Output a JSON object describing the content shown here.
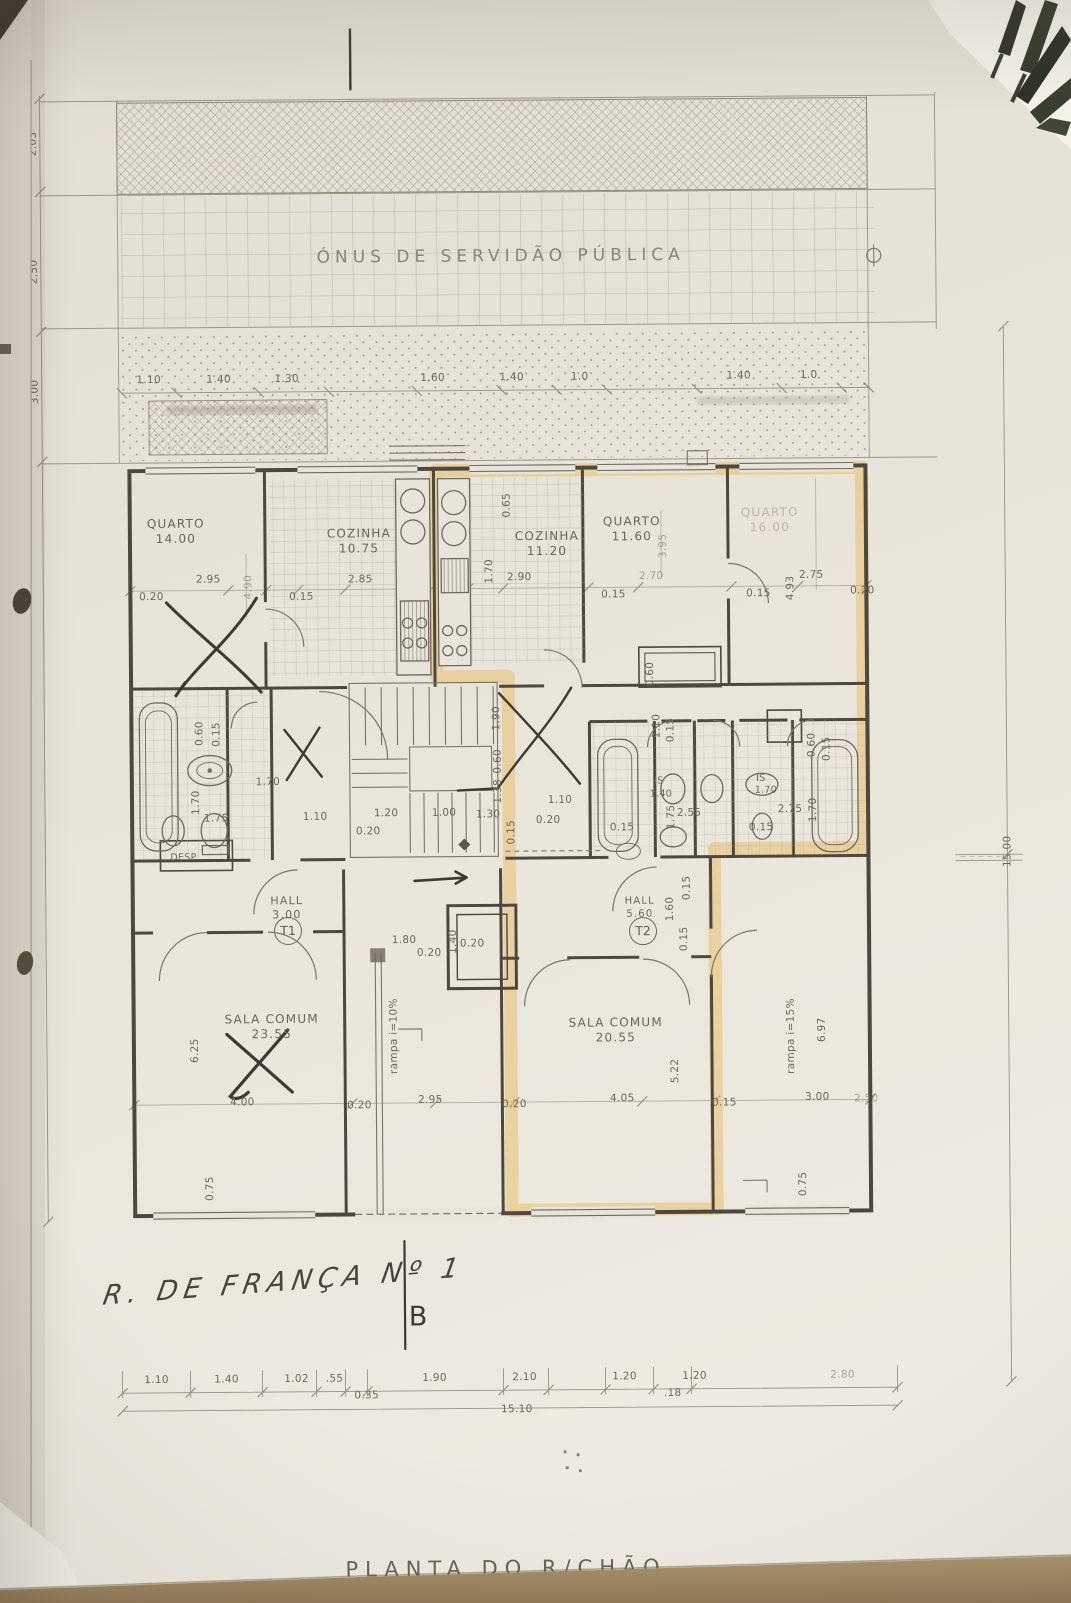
{
  "sheet": {
    "title": "PLANTA DO R/CHÃO",
    "band_label": "ÓNUS DE SERVIDÃO PÚBLICA"
  },
  "handwriting": {
    "street": "R. DE FRANÇA Nº 1",
    "section_mark": "B"
  },
  "units": {
    "t1": "T1",
    "t2": "T2"
  },
  "rooms": {
    "quarto1": {
      "name": "QUARTO",
      "area": "14.00"
    },
    "cozinha1": {
      "name": "COZINHA",
      "area": "10.75"
    },
    "cozinha2": {
      "name": "COZINHA",
      "area": "11.20"
    },
    "quarto2": {
      "name": "QUARTO",
      "area": "11.60"
    },
    "quarto3": {
      "name": "QUARTO",
      "area": "16.00"
    },
    "hall1": {
      "name": "HALL",
      "area": "3.00"
    },
    "hall2": {
      "name": "HALL",
      "area": "5.60"
    },
    "sala1": {
      "name": "SALA COMUM",
      "area": "23.55"
    },
    "sala2": {
      "name": "SALA COMUM",
      "area": "20.55"
    },
    "desp": {
      "name": "DESP."
    },
    "is1": {
      "name": "IS"
    },
    "is2": {
      "name": "IS"
    },
    "rampa1": {
      "name": "rampa i=10%"
    },
    "rampa2": {
      "name": "rampa i=15%"
    }
  },
  "dims": {
    "left": [
      "2.03",
      "2.50",
      "3.00",
      "22.03"
    ],
    "right_total": "15.00",
    "top_row": [
      "1.10",
      "1.40",
      "1.30",
      "1.60",
      "1.40",
      "1.0",
      "1.40",
      "1.0"
    ],
    "bottom_row": [
      "1.10",
      "1.40",
      "1.02",
      ".55",
      "1.90",
      "2.10",
      "1.20",
      "1.20",
      "2.80"
    ],
    "bottom_sub": [
      "0.35",
      ".18"
    ],
    "bottom_total": "15.10",
    "interior": [
      "2.95",
      "0.20",
      "4.90",
      "2.85",
      "0.15",
      "0.65",
      "1.70",
      "2.90",
      "3.95",
      "2.70",
      "0.15",
      "2.75",
      "4.93",
      "0.15",
      "0.20",
      "0.60",
      "0.15",
      "1.70",
      "1.70",
      "1.75",
      "1.10",
      "1.20",
      "0.20",
      "1.00",
      "1.30",
      "1.90",
      "0.60",
      "1.38",
      "0.15",
      "1.10",
      "0.20",
      "1.10",
      "0.15",
      "0.60",
      "1.40",
      "2.55",
      "1.75",
      "0.15",
      "1.70",
      "2.75",
      "1.70",
      "0.15",
      "0.60",
      "0.15",
      "1.80",
      "0.20",
      "1.40",
      "0.20",
      "6.25",
      "4.00",
      "0.20",
      "2.95",
      "0.20",
      "4.05",
      "5.22",
      "0.15",
      "3.00",
      "2.50",
      "6.97",
      "0.75",
      "0.75",
      "1.60",
      "0.15",
      "0.15"
    ]
  }
}
